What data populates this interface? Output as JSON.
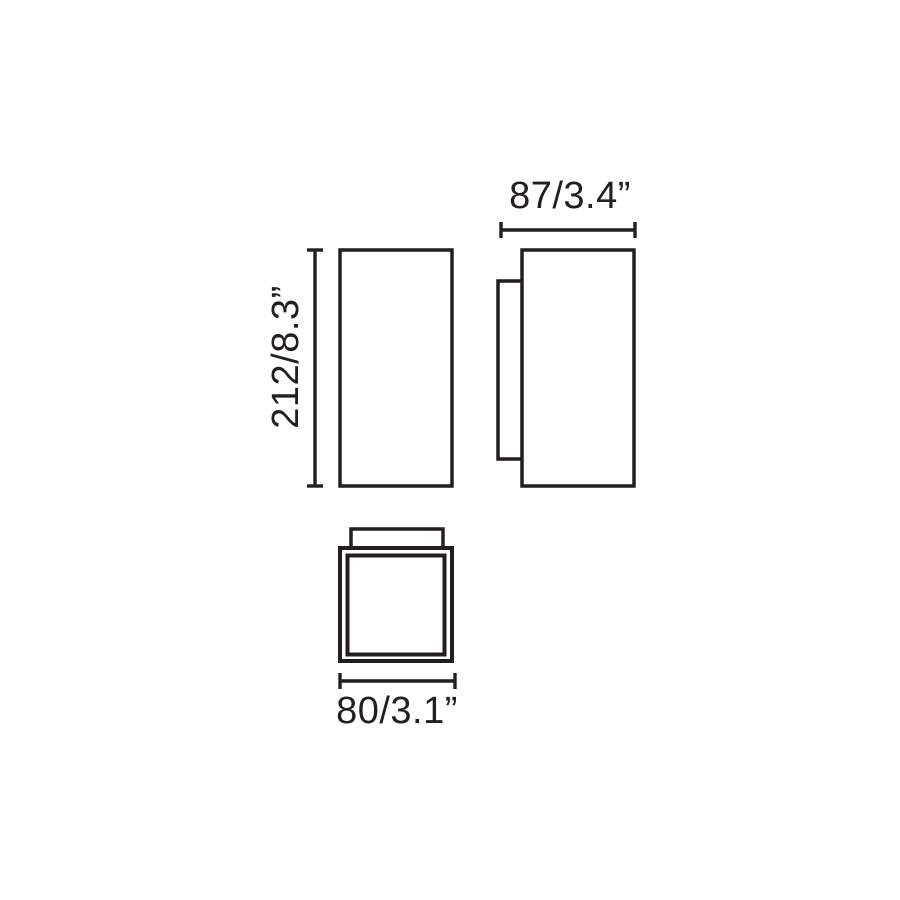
{
  "diagram": {
    "kind": "technical-dimension-drawing",
    "dimensions": {
      "height": "212/8.3”",
      "depth": "87/3.4”",
      "width": "80/3.1”"
    },
    "colors": {
      "ink": "#231f20",
      "background": "#ffffff"
    }
  }
}
